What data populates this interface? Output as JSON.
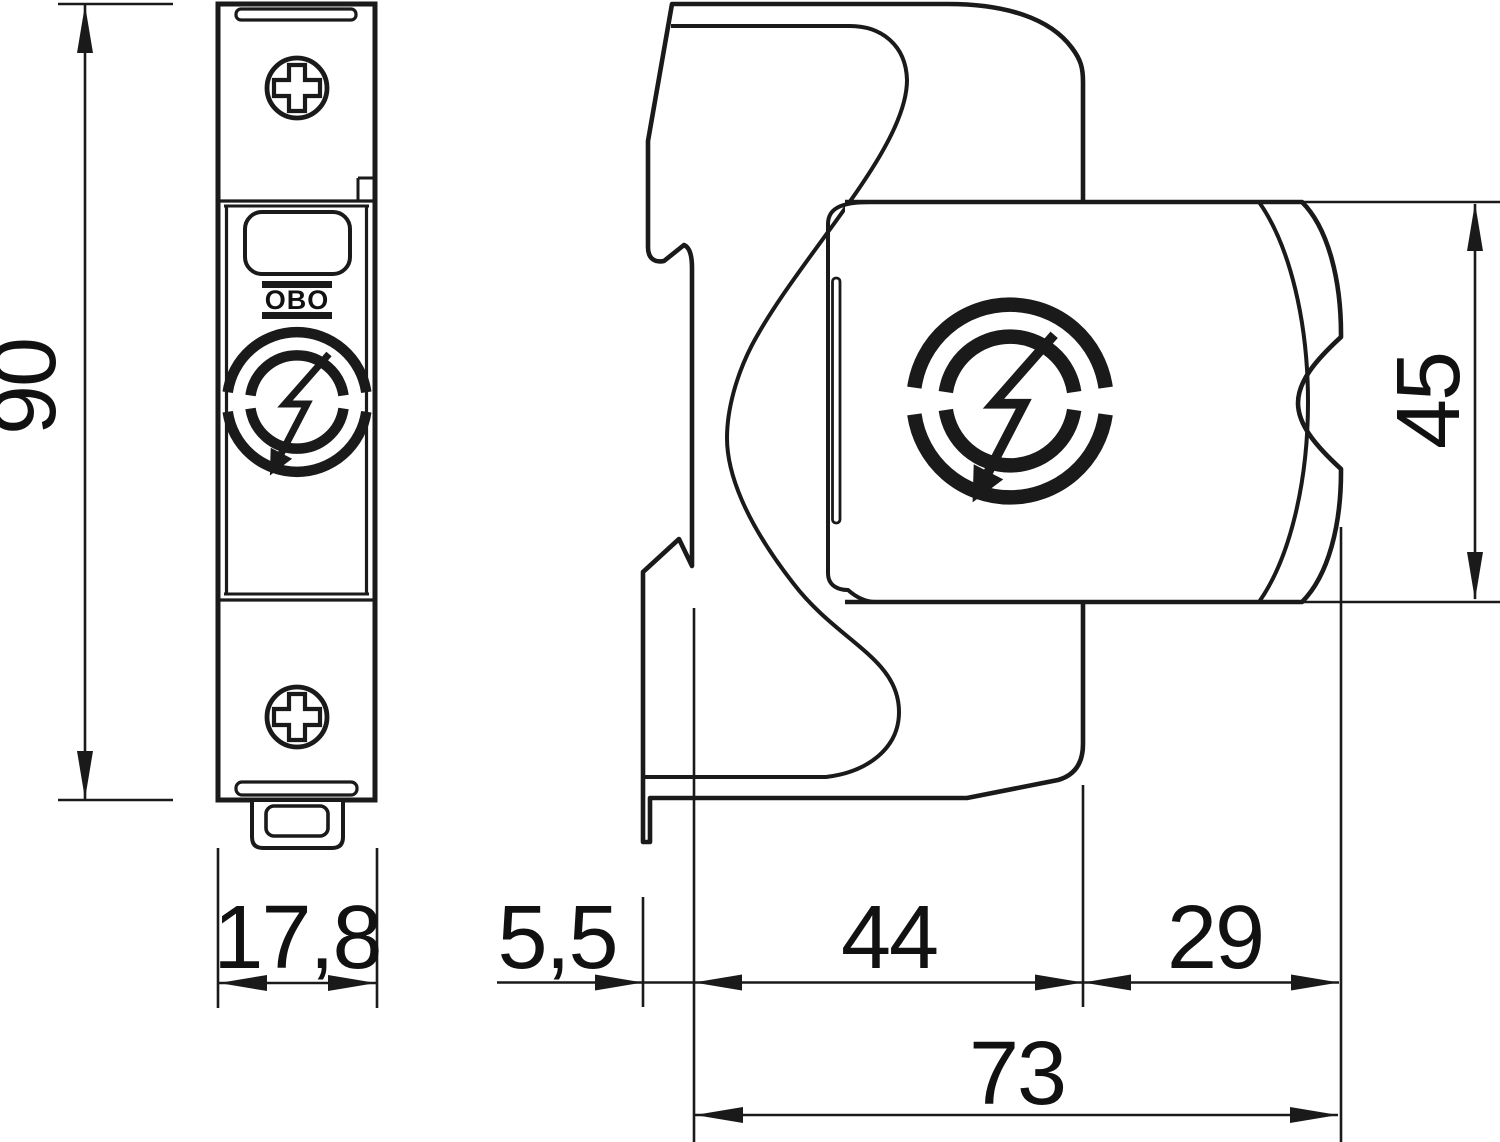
{
  "drawing": {
    "background": "#ffffff",
    "line_color": "#1a1a1a",
    "brand": "OBO",
    "views": [
      {
        "name": "front-view"
      },
      {
        "name": "side-view"
      }
    ],
    "dimensions": {
      "height": "90",
      "width": "17,8",
      "rail_offset": "5,5",
      "base_depth": "44",
      "module_depth": "29",
      "total_depth": "73",
      "module_height": "45"
    }
  }
}
